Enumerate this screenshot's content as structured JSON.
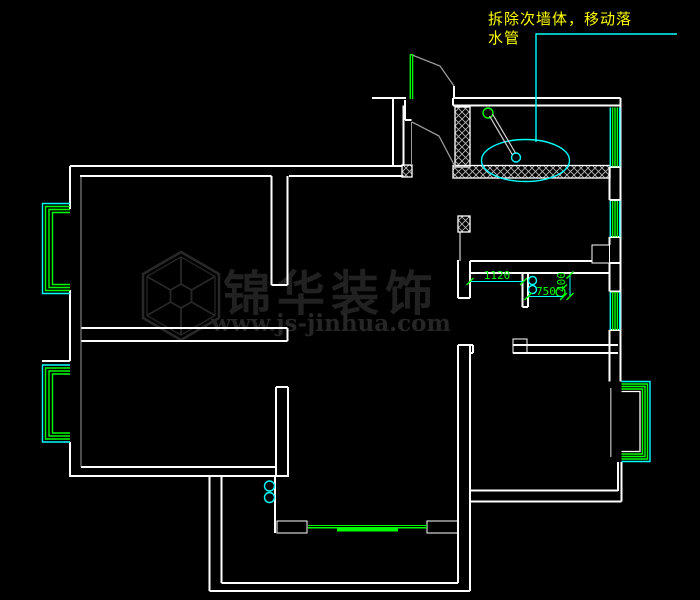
{
  "annotation": {
    "line1": "拆除次墙体，移动落",
    "line2": "水管",
    "color": "#ffff00"
  },
  "dimensions": {
    "kitchen_width": "1120",
    "pipe_offset": "750",
    "pipe_depth": "400",
    "text_color": "#00ff00",
    "line_color": "#00ffff"
  },
  "watermark": {
    "brand": "锦华装饰",
    "website": "www.js-jinhua.com",
    "color": "#232323"
  },
  "colors": {
    "background": "#000000",
    "walls": "#ffffff",
    "secondary_lines": "#9a9a9a",
    "window_outer": "#00ffff",
    "window_inner": "#00ff00",
    "annotation": "#ffff00",
    "dimension_line": "#00ffff",
    "dimension_text": "#00ff00",
    "hatch": "#b9b9b9",
    "fixture_cyan": "#00ffff",
    "fixture_green": "#00ff00"
  },
  "icons": {
    "basin": "ellipse-basin-icon",
    "drain": "drain-circle-icon",
    "downspout": "downspout-circle-icon",
    "logo": "hexagon-cube-logo"
  }
}
